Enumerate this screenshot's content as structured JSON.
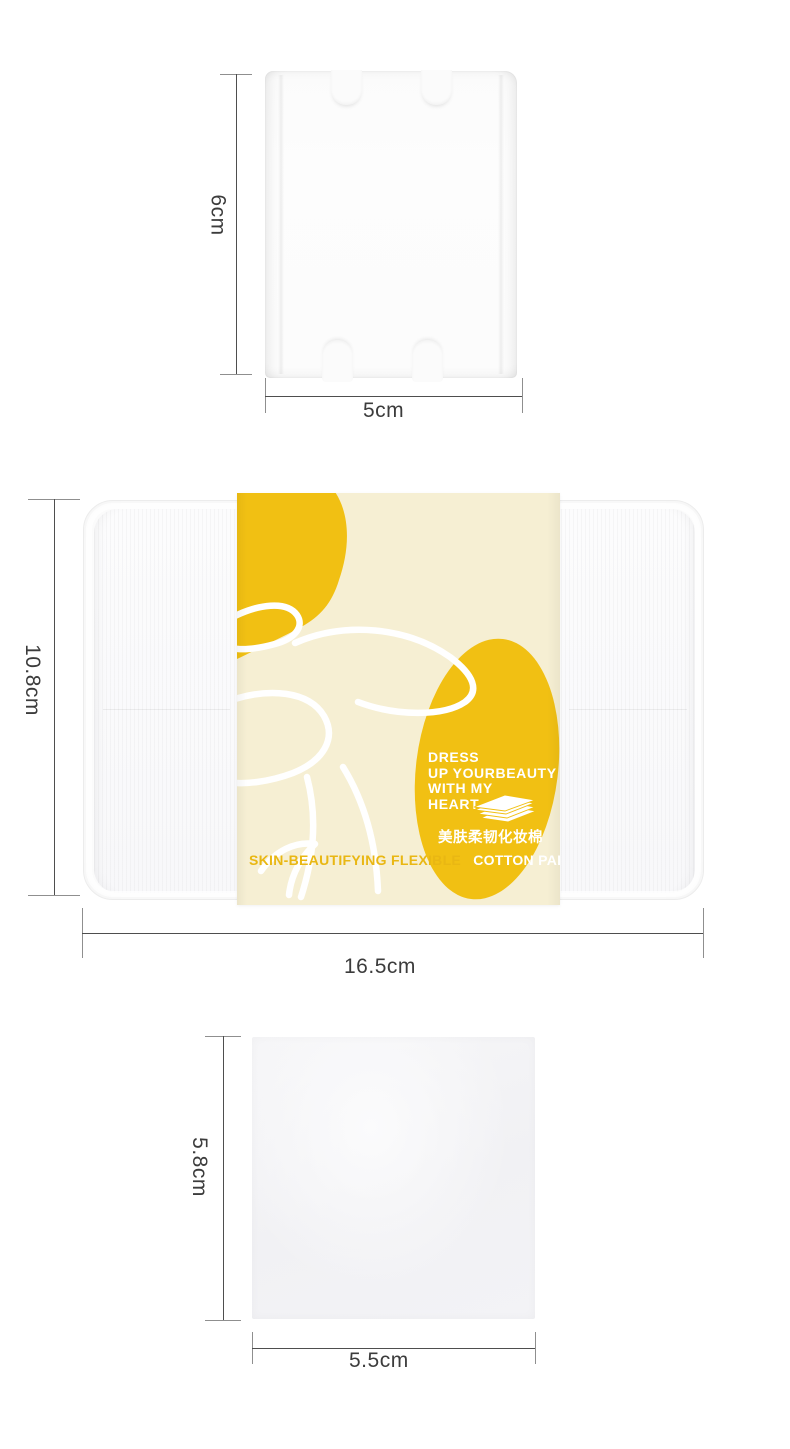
{
  "measurements": {
    "pad_rect": {
      "height": "6cm",
      "width": "5cm"
    },
    "box": {
      "height": "10.8cm",
      "width": "16.5cm"
    },
    "pad_square": {
      "height": "5.8cm",
      "width": "5.5cm"
    }
  },
  "package_label": {
    "slogan": [
      "DRESS",
      "UP YOURBEAUTY",
      "WITH MY",
      "HEART"
    ],
    "product_name_cn": "美肤柔韧化妆棉",
    "product_name_en_part1": "SKIN-BEAUTIFYING FLEXIBLE",
    "product_name_en_part2": "COTTON PAD",
    "icon": "cotton-pad-stack-icon",
    "colors": {
      "band_cream": "#f6efd3",
      "accent_yellow": "#f1c013",
      "en_text_yellow": "#e9b713",
      "text_white": "#ffffff"
    }
  }
}
